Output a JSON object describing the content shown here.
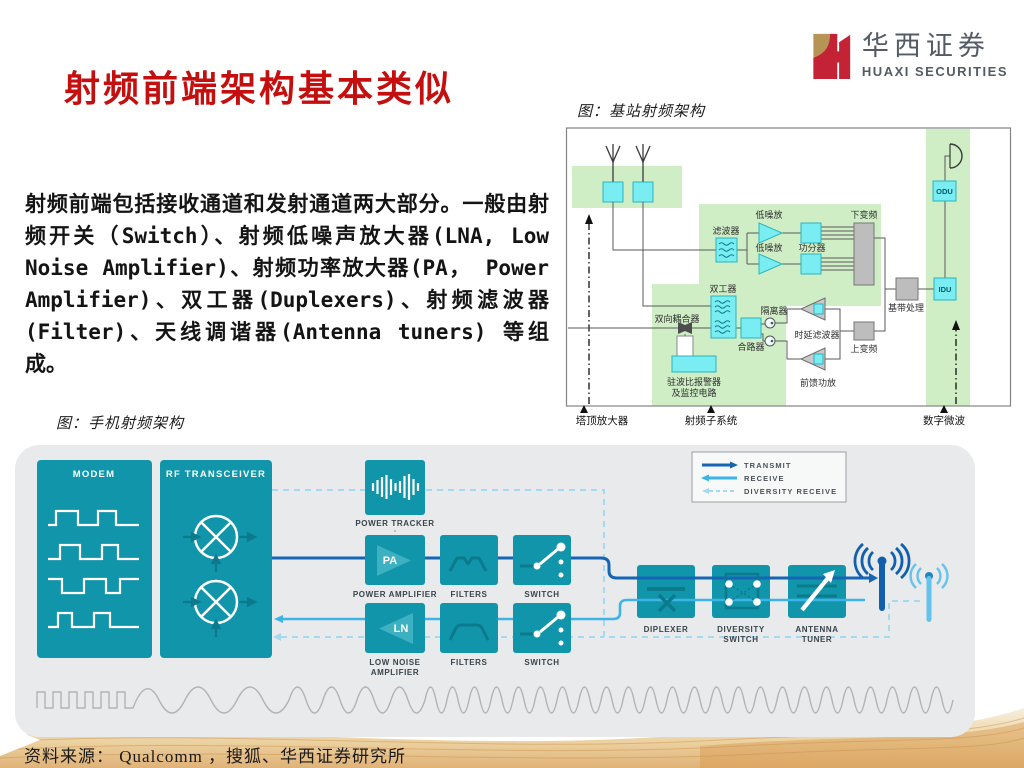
{
  "header": {
    "title": "射频前端架构基本类似",
    "logo_cn": "华西证券",
    "logo_en": "HUAXI SECURITIES"
  },
  "body": {
    "text": "射频前端包括接收通道和发射通道两大部分。一般由射频开关（Switch）、射频低噪声放大器(LNA, Low Noise Amplifier)、射频功率放大器(PA， Power Amplifier)、双工器(Duplexers)、射频滤波器(Filter)、天线调谐器(Antenna tuners) 等组成。"
  },
  "figures": {
    "base_station": {
      "caption": "图：基站射频架构",
      "labels": {
        "filter": "滤波器",
        "lna_top": "低噪放",
        "lna_bottom": "低噪放",
        "splitter": "功分器",
        "downconverter": "下变频",
        "duplexer": "双工器",
        "coupler": "双向耦合器",
        "isolator": "隔离器",
        "combiner": "合路器",
        "delay_filter": "时延滤波器",
        "upconverter": "上变频",
        "feedforward_amp": "前馈功放",
        "baseband": "基带处理",
        "vswr_line1": "驻波比报警器",
        "vswr_line2": "及监控电路",
        "odu": "ODU",
        "idu": "IDU",
        "axis_tower": "塔顶放大器",
        "axis_rf": "射频子系统",
        "axis_microwave": "数字微波"
      }
    },
    "phone": {
      "caption": "图：手机射频架构",
      "labels": {
        "modem": "MODEM",
        "transceiver": "RF TRANSCEIVER",
        "power_tracker": "POWER TRACKER",
        "pa": "PA",
        "power_amplifier": "POWER AMPLIFIER",
        "filters_tx": "FILTERS",
        "switch_tx": "SWITCH",
        "ln": "LN",
        "low_noise_line1": "LOW NOISE",
        "low_noise_line2": "AMPLIFIER",
        "filters_rx": "FILTERS",
        "switch_rx": "SWITCH",
        "diplexer": "DIPLEXER",
        "diversity_line1": "DIVERSITY",
        "diversity_line2": "SWITCH",
        "tuner_line1": "ANTENNA",
        "tuner_line2": "TUNER"
      },
      "legend": {
        "transmit": "TRANSMIT",
        "receive": "RECEIVE",
        "diversity": "DIVERSITY RECEIVE"
      }
    }
  },
  "footer": {
    "source": "资料来源： Qualcomm ，搜狐、华西证券研究所"
  },
  "colors": {
    "accent_red": "#c50f0f",
    "logo_gold": "#b59455",
    "logo_red": "#c32335",
    "teal": "#1095aa",
    "transmit_blue": "#1565b4",
    "receive_blue": "#3cb4e5",
    "diversity_blue": "#a5d9f0",
    "diagram_green": "#cfeec6",
    "diagram_cyan": "#79edf2"
  }
}
